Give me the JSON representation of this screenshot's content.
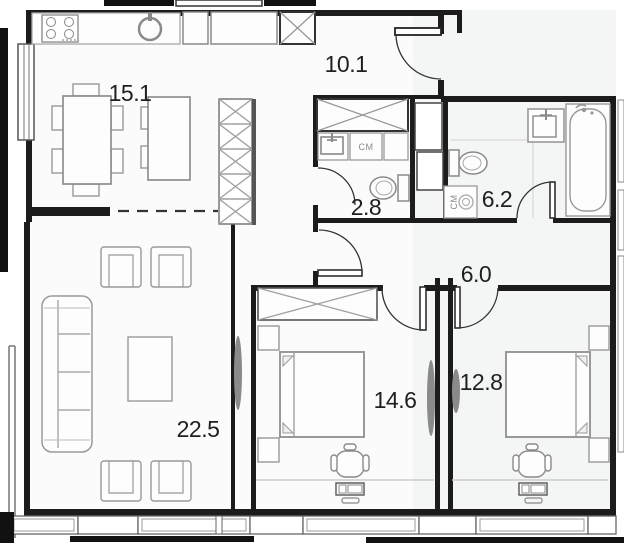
{
  "floorplan": {
    "title": "apartment-floor-plan",
    "rooms": [
      {
        "name": "kitchen-dining",
        "area_label": "15.1"
      },
      {
        "name": "entrance-hall",
        "area_label": "10.1"
      },
      {
        "name": "wc",
        "area_label": "2.8"
      },
      {
        "name": "bathroom",
        "area_label": "6.2"
      },
      {
        "name": "hallway",
        "area_label": "6.0"
      },
      {
        "name": "living-room",
        "area_label": "22.5"
      },
      {
        "name": "bedroom-1",
        "area_label": "14.6"
      },
      {
        "name": "bedroom-2",
        "area_label": "12.8"
      }
    ],
    "appliances": [
      {
        "label": "СМ",
        "location": "wc"
      },
      {
        "label": "СМ",
        "location": "bathroom"
      }
    ],
    "fixtures": [
      "stove-icon",
      "kitchen-sink-icon",
      "fridge-icon",
      "dining-table",
      "kitchen-island",
      "wardrobe-x",
      "sofa",
      "armchair",
      "coffee-table",
      "tv-lens",
      "double-bed",
      "nightstand",
      "desk-chair",
      "laptop",
      "toilet",
      "washbasin",
      "bathtub",
      "washing-machine",
      "door-swing-arc",
      "window"
    ],
    "colors": {
      "wall": "#1c1c1c",
      "furniture": "#999999",
      "furniture_dark": "#555555",
      "floor_left": "#fbfbfb",
      "floor_right": "#f4f5f5",
      "label": "#1f1f1f"
    }
  }
}
